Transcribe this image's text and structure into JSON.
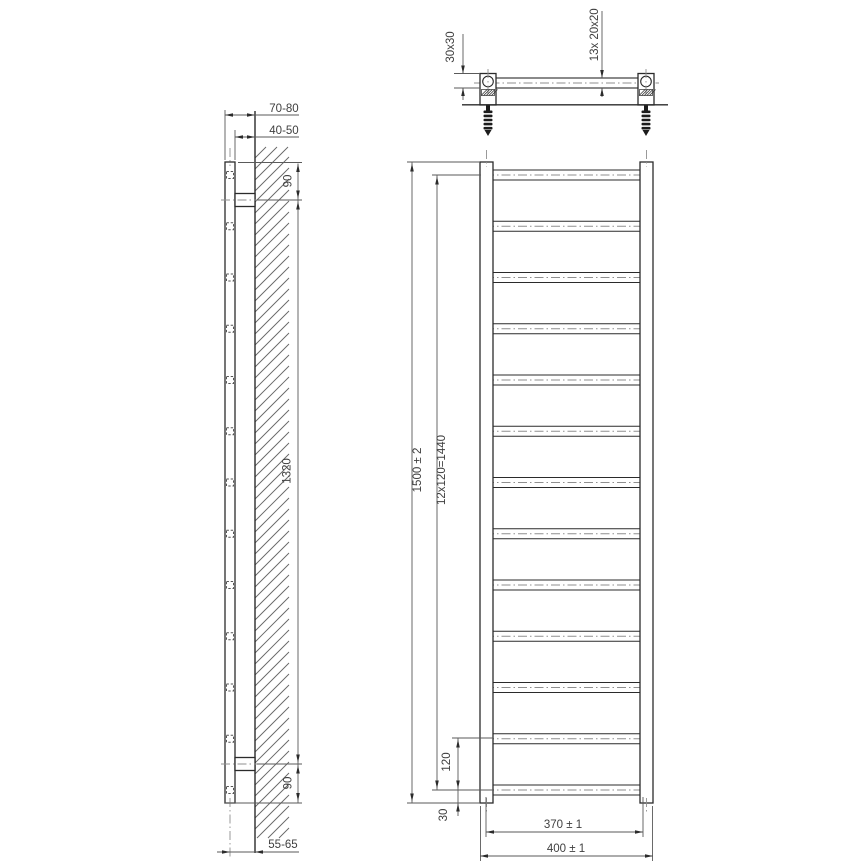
{
  "drawing": {
    "background": "#ffffff",
    "line_color": "#2b2b2b",
    "thin_line_color": "#5a5a5a",
    "centerline_color": "#8f8f8f",
    "text_color": "#3f3f3f"
  },
  "side_view": {
    "dim_wall_to_tube_front": "70-80",
    "dim_wall_to_tube_back": "40-50",
    "dim_top_bracket_offset": "90",
    "dim_bracket_spacing": "1320",
    "dim_bottom_bracket_offset": "90",
    "dim_wall_to_tube_center": "55-65",
    "rung_count": 13
  },
  "front_view": {
    "dim_overall_height": "1500 ± 2",
    "dim_rung_pitch_total": "12x120=1440",
    "dim_rung_pitch": "120",
    "dim_bottom_offset": "30",
    "dim_inner_width": "370 ± 1",
    "dim_overall_width": "400 ± 1",
    "rung_count": 13
  },
  "top_view": {
    "dim_vertical_tube_profile": "30x30",
    "dim_rung_count_label": "13x",
    "dim_rung_profile": "20x20"
  }
}
